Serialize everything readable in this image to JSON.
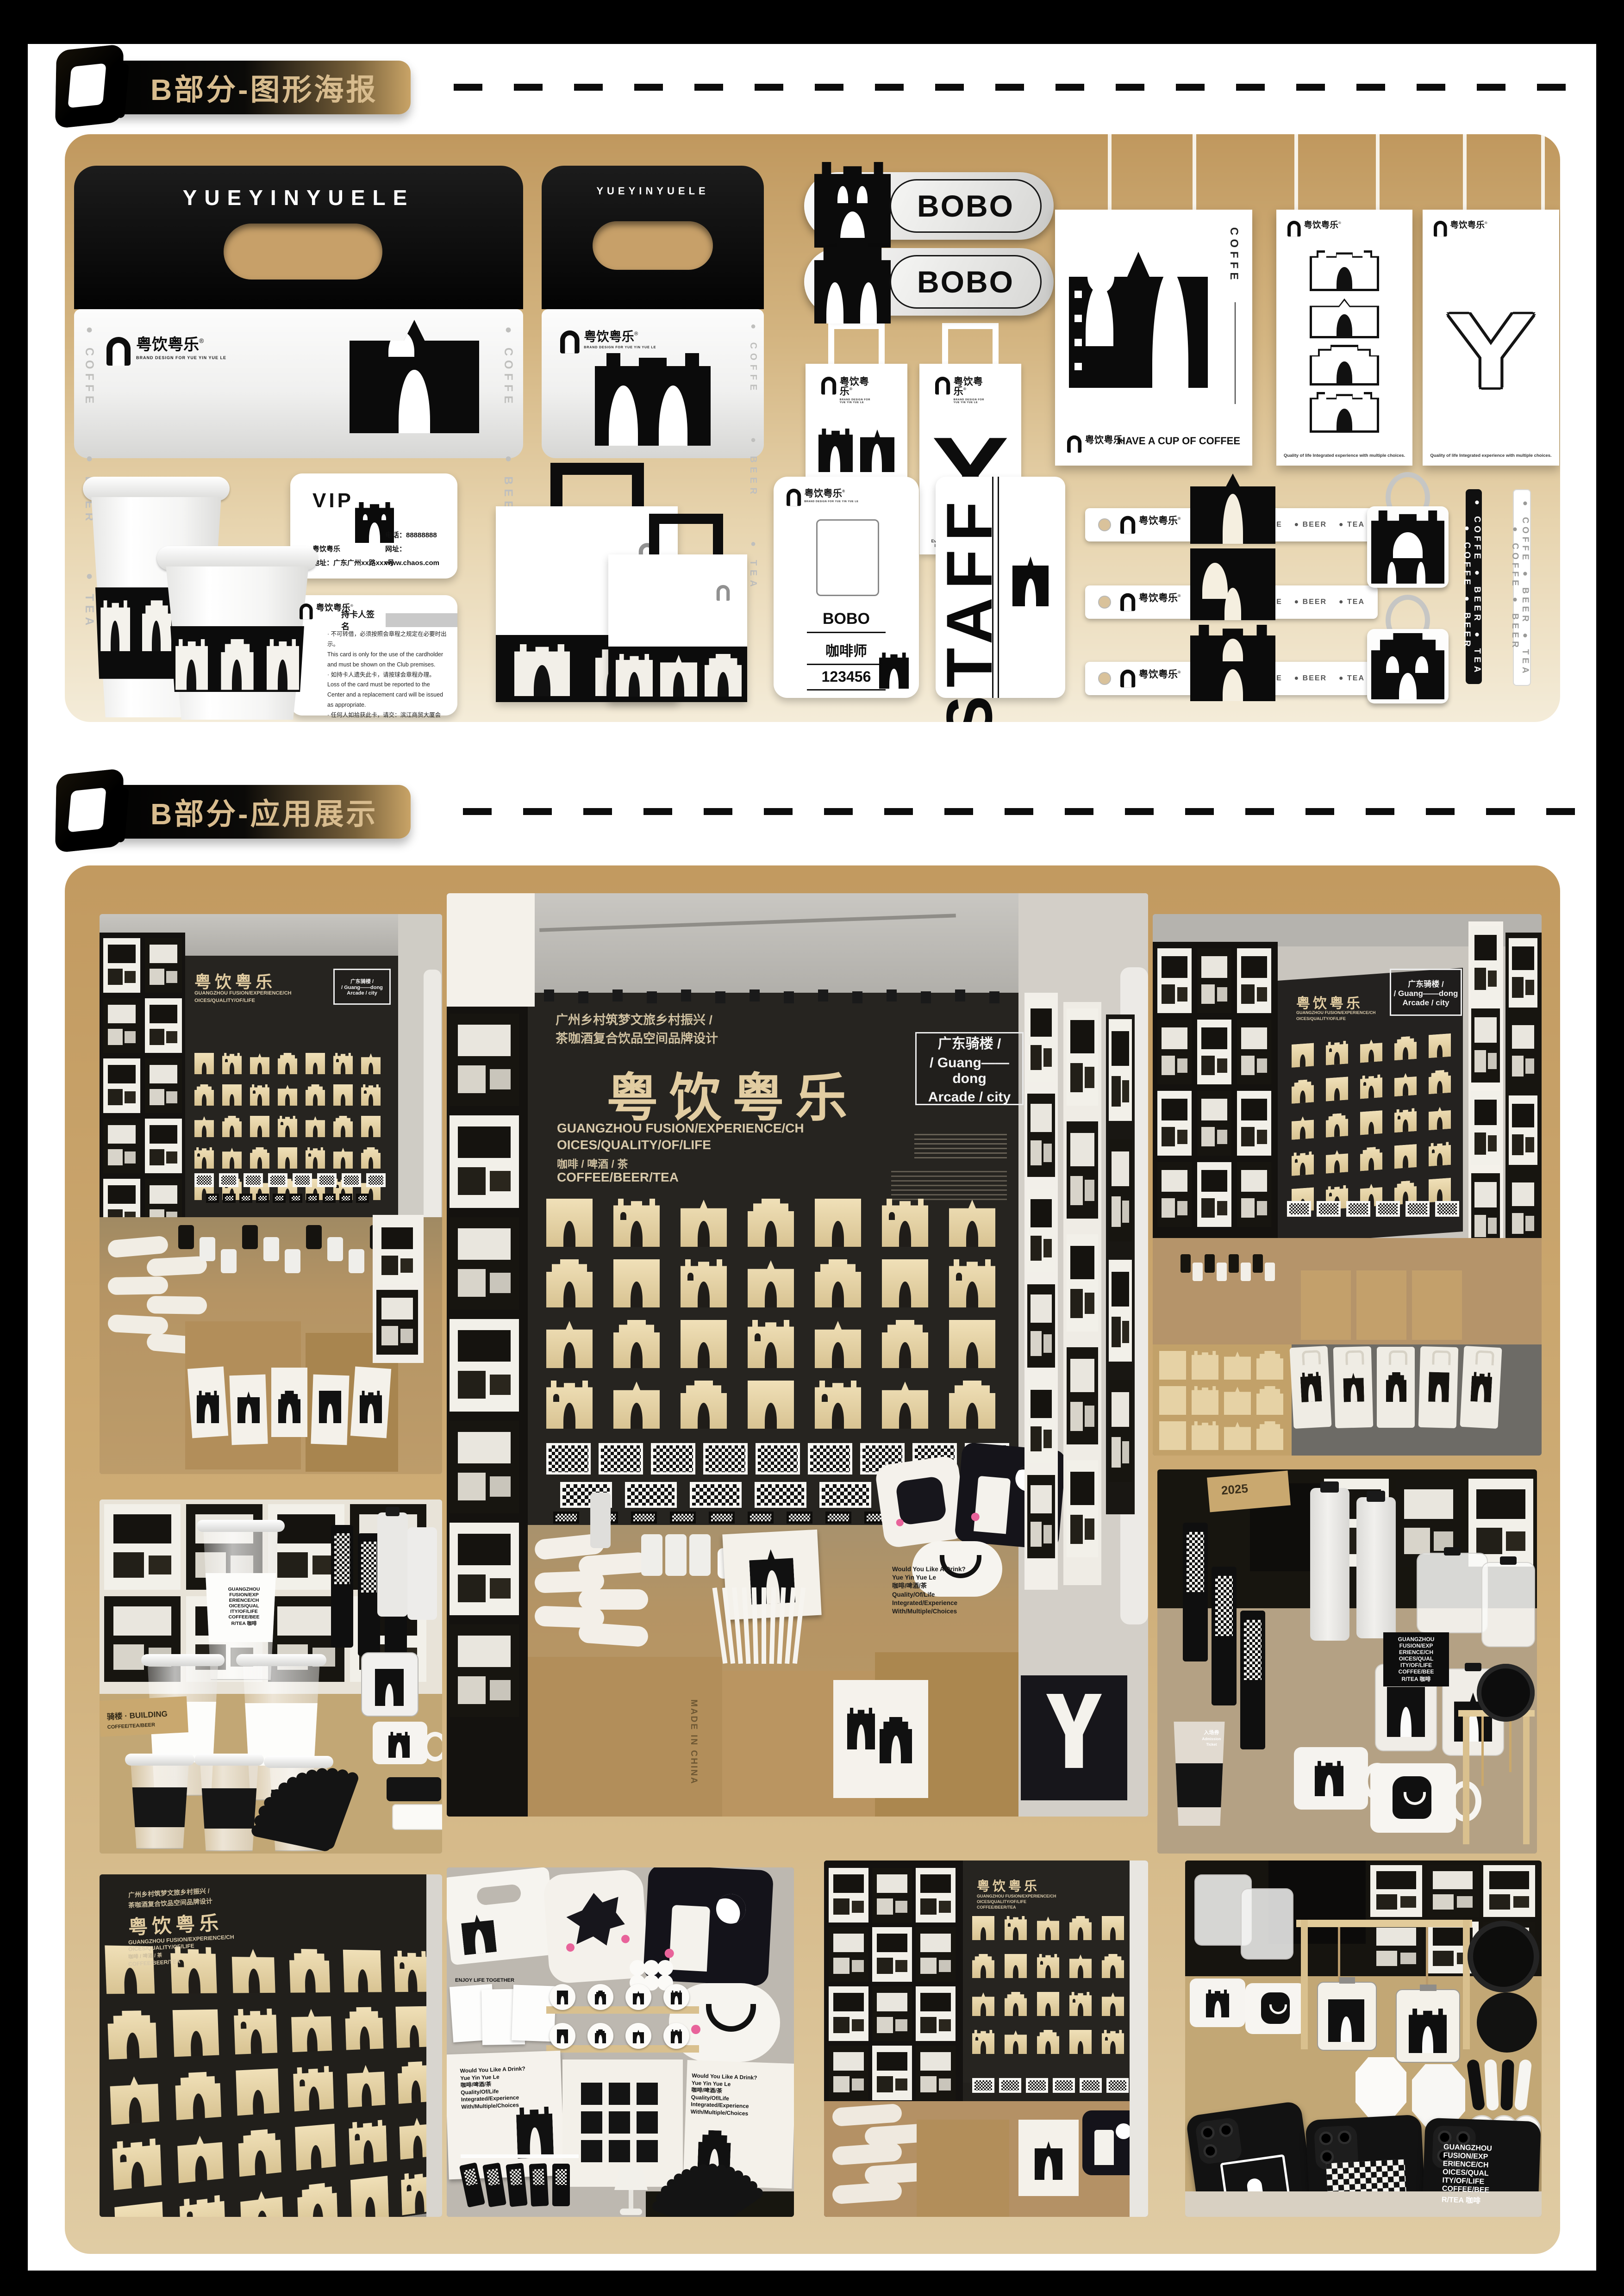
{
  "page": {
    "background": "#000000",
    "paper": "#ffffff"
  },
  "colors": {
    "accent_gold": "#c9a467",
    "header_text": "#d8bc8e",
    "panel_gradient_top": "#c0985e",
    "panel_gradient_bottom": "#f4ecd9",
    "wood_tile": "#e9d7ae",
    "black_wall": "#24211d",
    "kraft_box": "#b6925f"
  },
  "header1": {
    "label": "B部分-图形海报"
  },
  "header2": {
    "label": "B部分-应用展示"
  },
  "brand": {
    "cn": "粤饮粤乐",
    "reg": "®",
    "en": "YUEYINYUELE",
    "sub": "BRAND DESIGN FOR YUE YIN YUE LE"
  },
  "drinks": {
    "vertical": "● COFFE      ● BEER      ● TEA",
    "line": "● COFFE    ● BEER    ● TEA"
  },
  "badge": {
    "label": "BOBO"
  },
  "bag": {
    "caption": "Every time is the love and enjoyment of life, enjoy the relaxing time, enjoy it!"
  },
  "posters": {
    "side_label": "COFFE",
    "caption_coffee": "HAVE A CUP OF COFFEE",
    "caption_quality": "Quality of life Integrated experience with multiple choices."
  },
  "vip": {
    "title": "VIP",
    "company": "粤饮粤乐",
    "address": "地址：广东广州xx路xxx号",
    "phone": "电话：88888888",
    "web": "网址：www.chaos.com"
  },
  "vip_back": {
    "sign_label": "持卡人签名",
    "terms": "· 不可转借，必须按照会章程之规定在必要时出示。\nThis card is only for the use of the cardholder and must be shown on the Club premises.\n· 如持卡人遗失此卡，请按球会章程办理。\nLoss of the card must be reported to the Center and a replacement card will be issued as appropriate.\n· 任何人如拾获此卡，请交：滨江商贸大厦会所。\nIf found, please return to Changshu binjing Golf Club.\n· 最终解释权归本球会所有。\nThe interpretation shall be vested in the club."
  },
  "idcard": {
    "name": "BOBO",
    "role": "咖啡师",
    "number": "123456"
  },
  "staff": {
    "label": "STAFF"
  },
  "straw": {
    "text": "● COFFE ● BEER ● TEA ● COFFE ● BEER"
  },
  "booth": {
    "top1": "广州乡村筑梦文旅乡村振兴 /",
    "top2": "茶咖酒复合饮品空间品牌设计",
    "logo": "粤饮粤乐",
    "en1": "GUANGZHOU FUSION/EXPERIENCE/CH",
    "en2": "OICES/QUALITY/OF/LIFE",
    "cn": "咖啡 / 啤酒 / 茶",
    "en3": "COFFEE/BEER/TEA",
    "tag1": "广东骑楼 /",
    "tag2": "/ Guang——dong",
    "tag3": "Arcade / city"
  },
  "tote": {
    "text": "Would You Like A Drink?\nYue Yin Yue Le\n咖啡/啤酒/茶\nQuality/Of/Life\nIntegrated/Experience\nWith/Multiple/Choices"
  },
  "bottle_label": {
    "text": "GUANGZHOU\nFUSION/EXP\nERIENCE/CH\nOICES/QUAL\nITY/OF/LIFE\nCOFFEE/BEE\nR/TEA 咖啡"
  },
  "labels": {
    "made_in": "MADE IN CHINA",
    "enjoy": "ENJOY LIFE TOGETHER",
    "ticket_cn": "入场券",
    "ticket_en": "Admission Ticket",
    "year": "2025",
    "kraft_cn": "骑楼",
    "kraft_en": "BUILDING",
    "kraft_drinks": "COFFEE/TEA/BEER"
  }
}
